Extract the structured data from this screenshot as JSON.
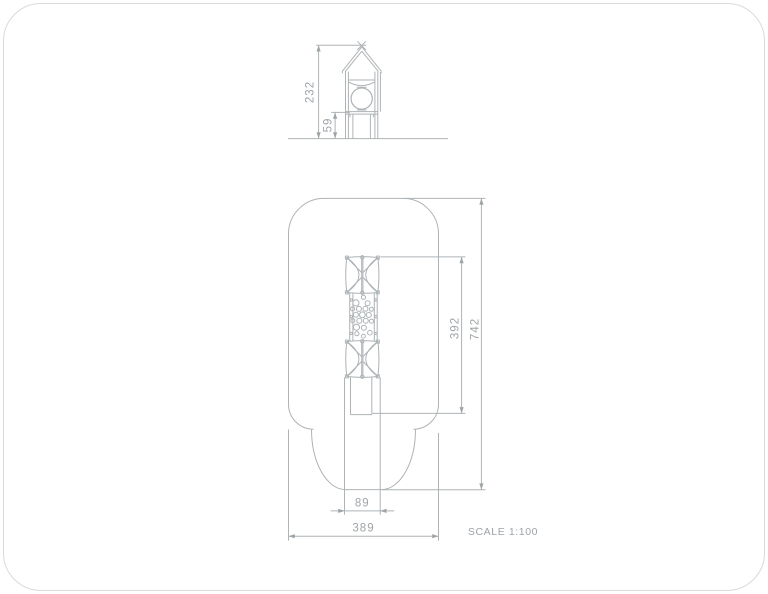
{
  "sheet": {
    "title": "Playground tower technical drawing",
    "scale_label": "SCALE 1:100",
    "colors": {
      "line": "#aeb3b6",
      "dim_text": "#9ea4a7",
      "border": "#d8dadb",
      "background": "#ffffff"
    },
    "elevation": {
      "name": "front elevation",
      "dims": {
        "total_height": {
          "value": "232",
          "orientation": "vertical"
        },
        "platform_height": {
          "value": "59",
          "orientation": "vertical"
        }
      }
    },
    "plan": {
      "name": "plan view with safety zone",
      "dims": {
        "equipment_length": {
          "value": "392",
          "orientation": "vertical"
        },
        "zone_length": {
          "value": "742",
          "orientation": "vertical"
        },
        "tower_width": {
          "value": "89",
          "orientation": "horizontal"
        },
        "zone_width": {
          "value": "389",
          "orientation": "horizontal"
        }
      }
    }
  }
}
